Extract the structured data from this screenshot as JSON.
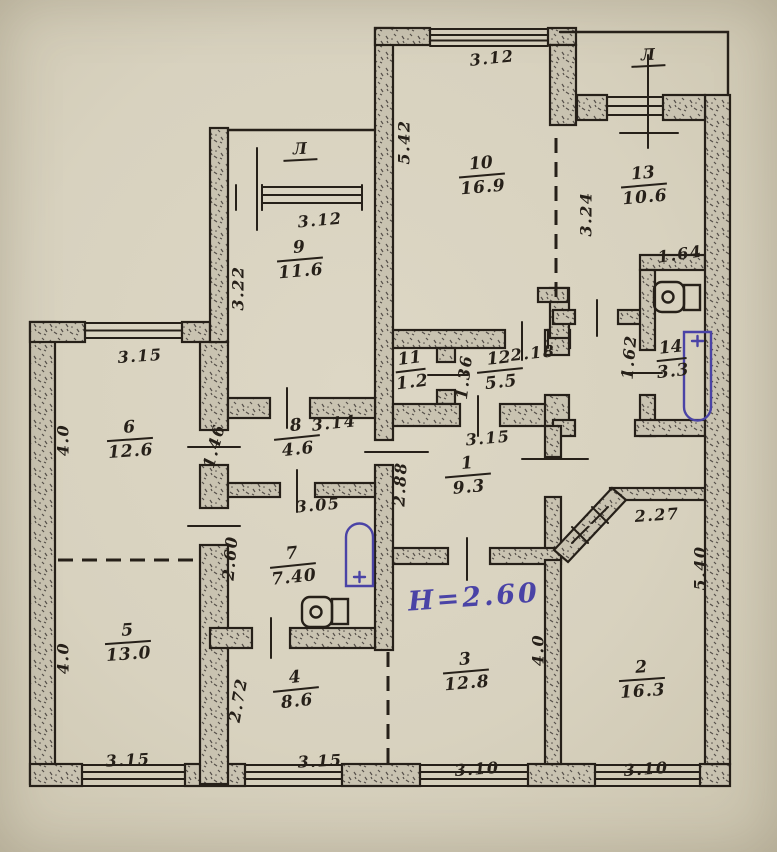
{
  "colors": {
    "paper": "#d8d2bf",
    "ink": "#262019",
    "blue_ink": "#4a43a6",
    "wall_fill": "#c9c3b1"
  },
  "height_note": {
    "text": "Н=2.60",
    "x": 408,
    "y": 582,
    "rot": -4
  },
  "balcony_labels": [
    {
      "text": "Л",
      "x": 288,
      "y": 138
    },
    {
      "text": "Л",
      "x": 636,
      "y": 44
    }
  ],
  "room_labels": [
    {
      "number": "10",
      "area": "16.9",
      "x": 482,
      "y": 176,
      "rot": -5
    },
    {
      "number": "13",
      "area": "10.6",
      "x": 644,
      "y": 186,
      "rot": -5
    },
    {
      "number": "9",
      "area": "11.6",
      "x": 300,
      "y": 260,
      "rot": -5
    },
    {
      "number": "11",
      "area": "1.2",
      "x": 411,
      "y": 371,
      "rot": -7,
      "small": true
    },
    {
      "number": "12",
      "area": "5.5",
      "x": 500,
      "y": 371,
      "rot": -6
    },
    {
      "number": "14",
      "area": "3.3",
      "x": 672,
      "y": 360,
      "rot": -6,
      "small": true
    },
    {
      "number": "6",
      "area": "12.6",
      "x": 130,
      "y": 440,
      "rot": -4
    },
    {
      "number": "8",
      "area": "4.6",
      "x": 297,
      "y": 438,
      "rot": -6
    },
    {
      "number": "1",
      "area": "9.3",
      "x": 468,
      "y": 476,
      "rot": -5
    },
    {
      "number": "7",
      "area": "7.40",
      "x": 293,
      "y": 566,
      "rot": -6
    },
    {
      "number": "5",
      "area": "13.0",
      "x": 128,
      "y": 643,
      "rot": -4
    },
    {
      "number": "4",
      "area": "8.6",
      "x": 296,
      "y": 690,
      "rot": -6
    },
    {
      "number": "3",
      "area": "12.8",
      "x": 466,
      "y": 672,
      "rot": -5
    },
    {
      "number": "2",
      "area": "16.3",
      "x": 642,
      "y": 680,
      "rot": -4
    }
  ],
  "dim_labels": [
    {
      "text": "3.12",
      "x": 492,
      "y": 58,
      "rot": -6
    },
    {
      "text": "5.42",
      "x": 404,
      "y": 142,
      "rot": -90
    },
    {
      "text": "3.24",
      "x": 586,
      "y": 214,
      "rot": -90
    },
    {
      "text": "1.64",
      "x": 680,
      "y": 254,
      "rot": -8
    },
    {
      "text": "3.12",
      "x": 320,
      "y": 220,
      "rot": -5
    },
    {
      "text": "3.22",
      "x": 238,
      "y": 288,
      "rot": -90
    },
    {
      "text": "1.36",
      "x": 464,
      "y": 377,
      "rot": -83
    },
    {
      "text": "2.18",
      "x": 533,
      "y": 353,
      "rot": -6
    },
    {
      "text": "1.62",
      "x": 629,
      "y": 357,
      "rot": -85
    },
    {
      "text": "3.15",
      "x": 140,
      "y": 356,
      "rot": -4
    },
    {
      "text": "4.0",
      "x": 63,
      "y": 440,
      "rot": -90
    },
    {
      "text": "1.46",
      "x": 214,
      "y": 446,
      "rot": -75
    },
    {
      "text": "3.14",
      "x": 334,
      "y": 423,
      "rot": -6
    },
    {
      "text": "3.15",
      "x": 488,
      "y": 438,
      "rot": -5
    },
    {
      "text": "2.88",
      "x": 400,
      "y": 484,
      "rot": -87
    },
    {
      "text": "2.60",
      "x": 230,
      "y": 558,
      "rot": -85
    },
    {
      "text": "3.05",
      "x": 318,
      "y": 505,
      "rot": -5
    },
    {
      "text": "2.27",
      "x": 657,
      "y": 515,
      "rot": -4
    },
    {
      "text": "5.40",
      "x": 700,
      "y": 568,
      "rot": -90
    },
    {
      "text": "4.0",
      "x": 538,
      "y": 650,
      "rot": -90
    },
    {
      "text": "4.0",
      "x": 63,
      "y": 658,
      "rot": -90
    },
    {
      "text": "2.72",
      "x": 238,
      "y": 700,
      "rot": -80
    },
    {
      "text": "3.15",
      "x": 128,
      "y": 760,
      "rot": -3
    },
    {
      "text": "3.15",
      "x": 320,
      "y": 761,
      "rot": -3
    },
    {
      "text": "3.10",
      "x": 477,
      "y": 769,
      "rot": -4
    },
    {
      "text": "3.10",
      "x": 646,
      "y": 769,
      "rot": -4
    }
  ]
}
